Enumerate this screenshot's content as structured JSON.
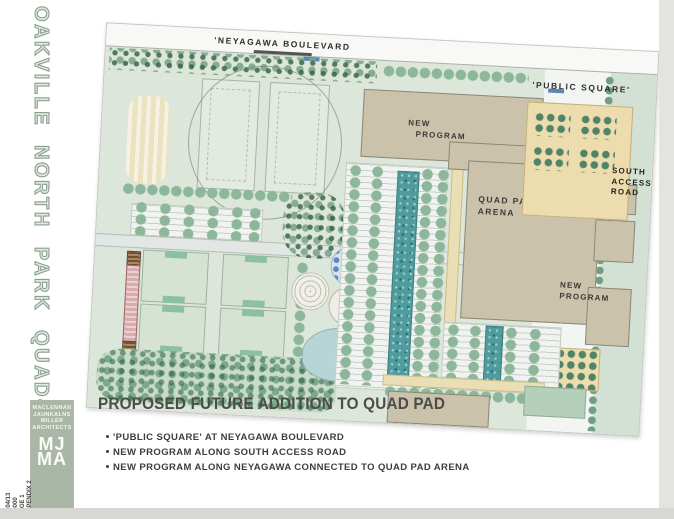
{
  "margin": {
    "vertical_title": "OAKVILLE NORTH PARK QUAD-PAD",
    "titleblock": {
      "firm_lines": [
        "MACLENNAN",
        "JAUNKALNS",
        "MILLER",
        "ARCHITECTS"
      ],
      "logo_top": "MJ",
      "logo_bottom": "MA",
      "side_lines": [
        "08/04/13",
        "1:3000",
        "PAGE 1",
        "APPENDIX 2"
      ]
    }
  },
  "plan": {
    "road_labels": {
      "neyagawa": "'NEYAGAWA BOULEVARD",
      "public_square": "'PUBLIC SQUARE'",
      "south_access": [
        "SOUTH",
        "ACCESS",
        "ROAD"
      ]
    },
    "building_labels": {
      "new_program_north": [
        "NEW",
        "PROGRAM"
      ],
      "quad_pad_arena": [
        "QUAD PAD",
        "ARENA"
      ],
      "new_program_east": [
        "NEW",
        "PROGRAM"
      ]
    }
  },
  "annotation": {
    "title": "PROPOSED FUTURE ADDITION TO QUAD PAD",
    "bullets": [
      "'PUBLIC SQUARE' AT NEYAGAWA BOULEVARD",
      "NEW PROGRAM ALONG SOUTH ACCESS ROAD",
      "NEW PROGRAM ALONG NEYAGAWA CONNECTED TO QUAD PAD ARENA"
    ]
  },
  "colors": {
    "park_green": "#dde6da",
    "building_tan": "#cbc2ac",
    "public_square_beige": "#ecdcae",
    "pond_blue": "#b7d4d7",
    "bioswale_teal": "#4f9c9e",
    "access_road_green": "#d3e1d5",
    "tree_green": "#567f63",
    "mjma_block_green": "#abb7a6",
    "ink": "#3c3c3a"
  }
}
